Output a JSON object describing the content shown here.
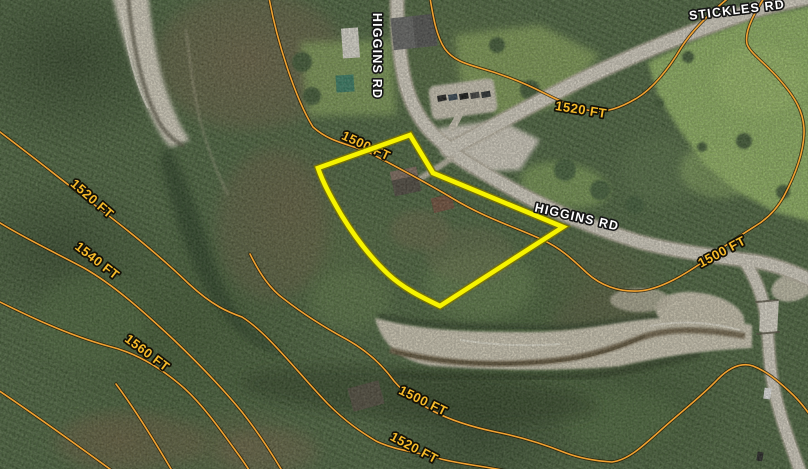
{
  "map": {
    "description": "Aerial parcel map with topographic contour overlay",
    "colors": {
      "parcel_boundary": "#f6f300",
      "contour_line": "#f0a232",
      "contour_label": "#f7bb2a",
      "road_label": "#ffffff",
      "road_surface": "#d6d0c3",
      "creek_gravel": "#d5cfbf"
    },
    "road_labels": [
      {
        "text": "HIGGINS RD",
        "orientation": "vertical"
      },
      {
        "text": "STICKLES RD",
        "orientation": "diagonal-clipped-top"
      },
      {
        "text": "HIGGINS RD",
        "orientation": "diagonal"
      }
    ],
    "contour_labels": [
      {
        "text": "1500 FT",
        "position": "center-on-parcel-top"
      },
      {
        "text": "1520 FT",
        "position": "upper-right-of-intersection"
      },
      {
        "text": "1520 FT",
        "position": "left-upper"
      },
      {
        "text": "1540 FT",
        "position": "left-middle"
      },
      {
        "text": "1560 FT",
        "position": "left-lower"
      },
      {
        "text": "1500 FT",
        "position": "right-on-road"
      },
      {
        "text": "1500 FT",
        "position": "bottom-center"
      },
      {
        "text": "1520 FT",
        "position": "bottom-center-lower"
      }
    ],
    "parcel": {
      "highlighted": true,
      "boundary_color": "#f6f300"
    }
  }
}
